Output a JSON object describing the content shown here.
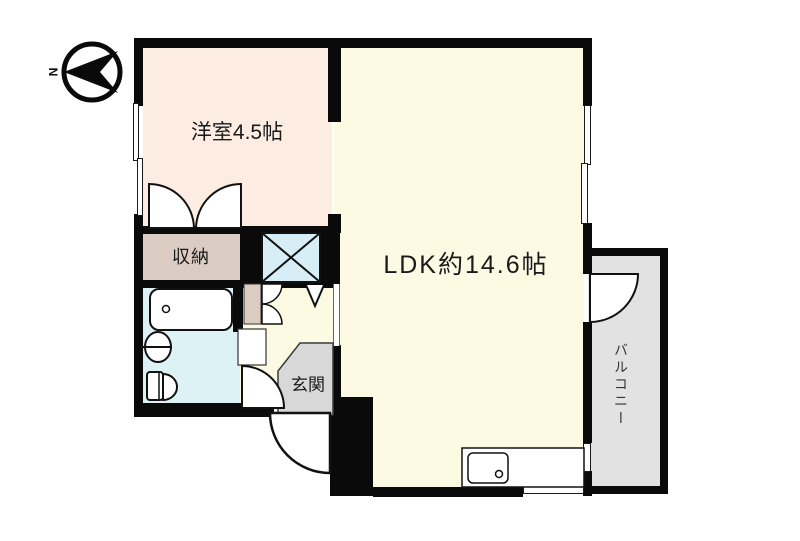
{
  "plan_title": "apartment-floor-plan",
  "compass": {
    "north_label": "N"
  },
  "rooms": {
    "western_room": {
      "label": "洋室4.5帖",
      "color": "#fcece1"
    },
    "ldk": {
      "label": "LDK約14.6帖",
      "color": "#fcfae2"
    },
    "storage": {
      "label": "収納",
      "color": "#dbccc4"
    },
    "entrance": {
      "label": "玄関",
      "color": "#d8d8d8"
    },
    "balcony": {
      "label": "バルコニー",
      "color": "#e2e2e2"
    },
    "washroom": {
      "color": "#ddf2f4"
    },
    "hallway": {
      "color": "#fcfae2"
    },
    "shaft": {
      "color": "#d7eef7"
    }
  },
  "wall_color": "#0a0a0a",
  "fixture_color": "#ffffff",
  "line_color": "#111111"
}
